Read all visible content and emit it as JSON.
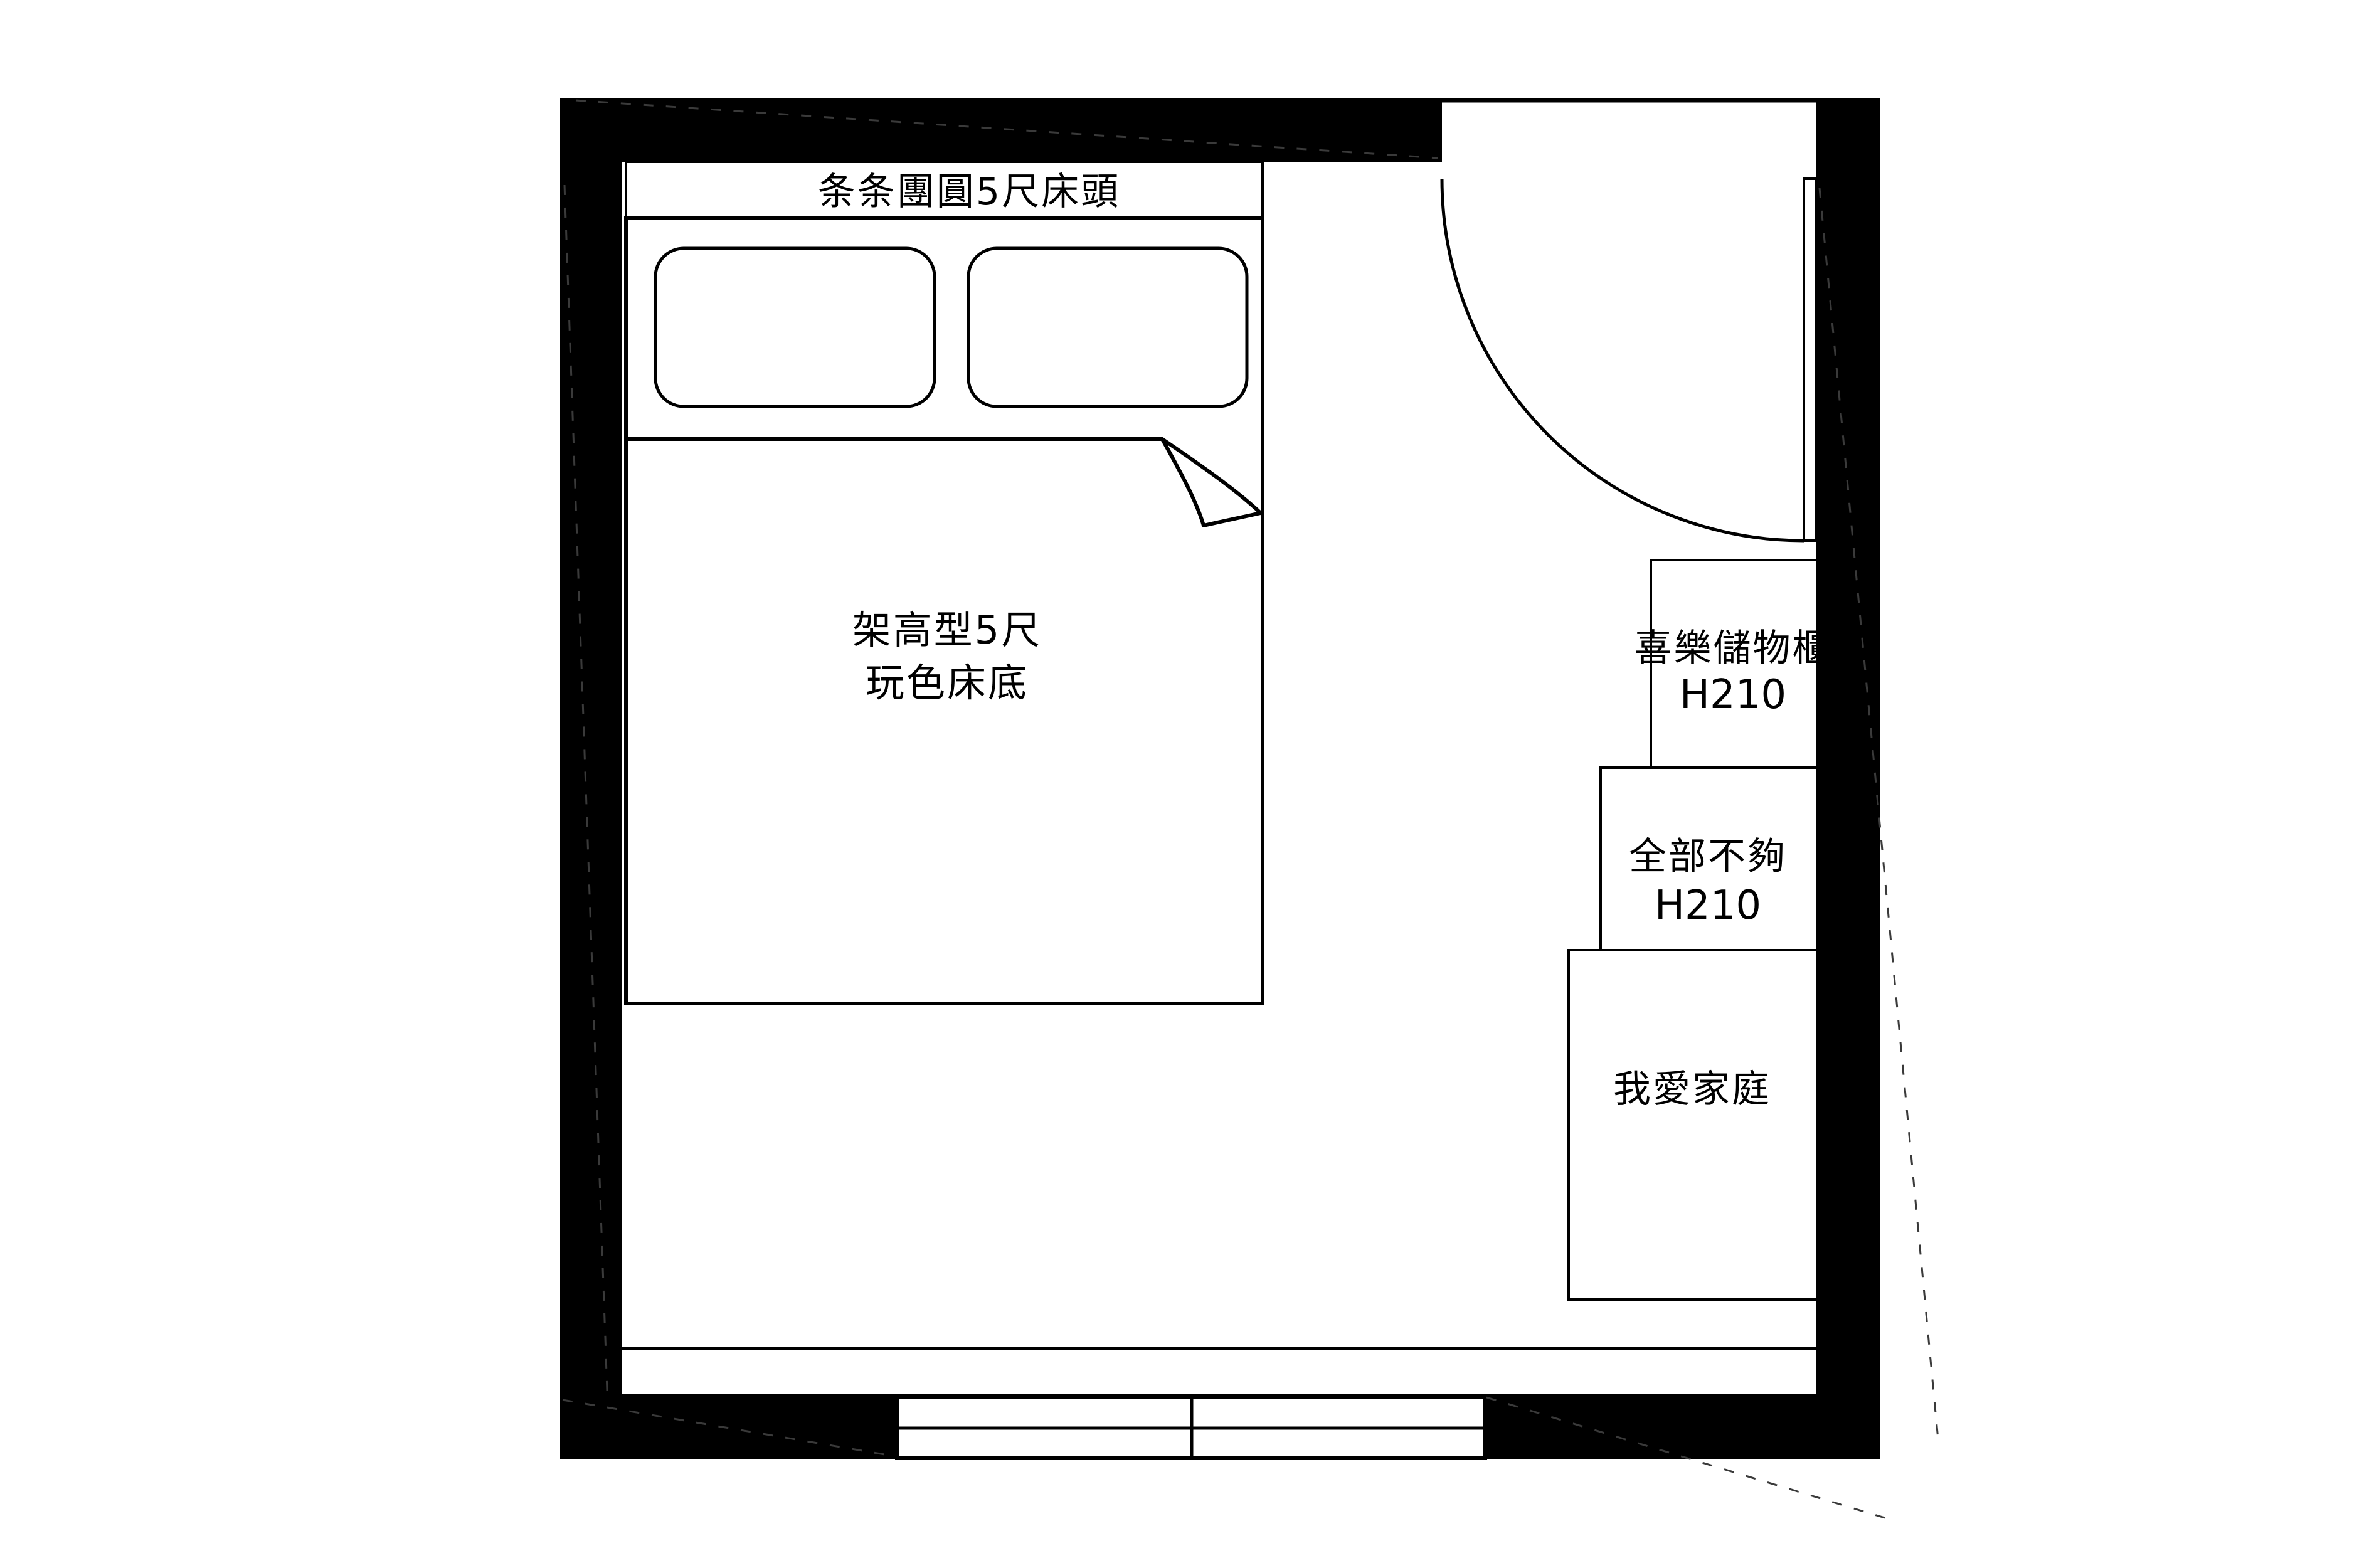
{
  "floorplan": {
    "headboard_label": "条条團圓5尺床頭",
    "bed_label": {
      "line1": "架高型5尺",
      "line2": "玩色床底"
    },
    "cabinets": [
      {
        "name": "喜樂儲物櫃",
        "size": "H210"
      },
      {
        "name": "全部不夠",
        "size": "H210"
      },
      {
        "name": "我愛家庭"
      }
    ],
    "colors": {
      "wall": "#000000",
      "line": "#000000",
      "background": "#ffffff"
    }
  }
}
